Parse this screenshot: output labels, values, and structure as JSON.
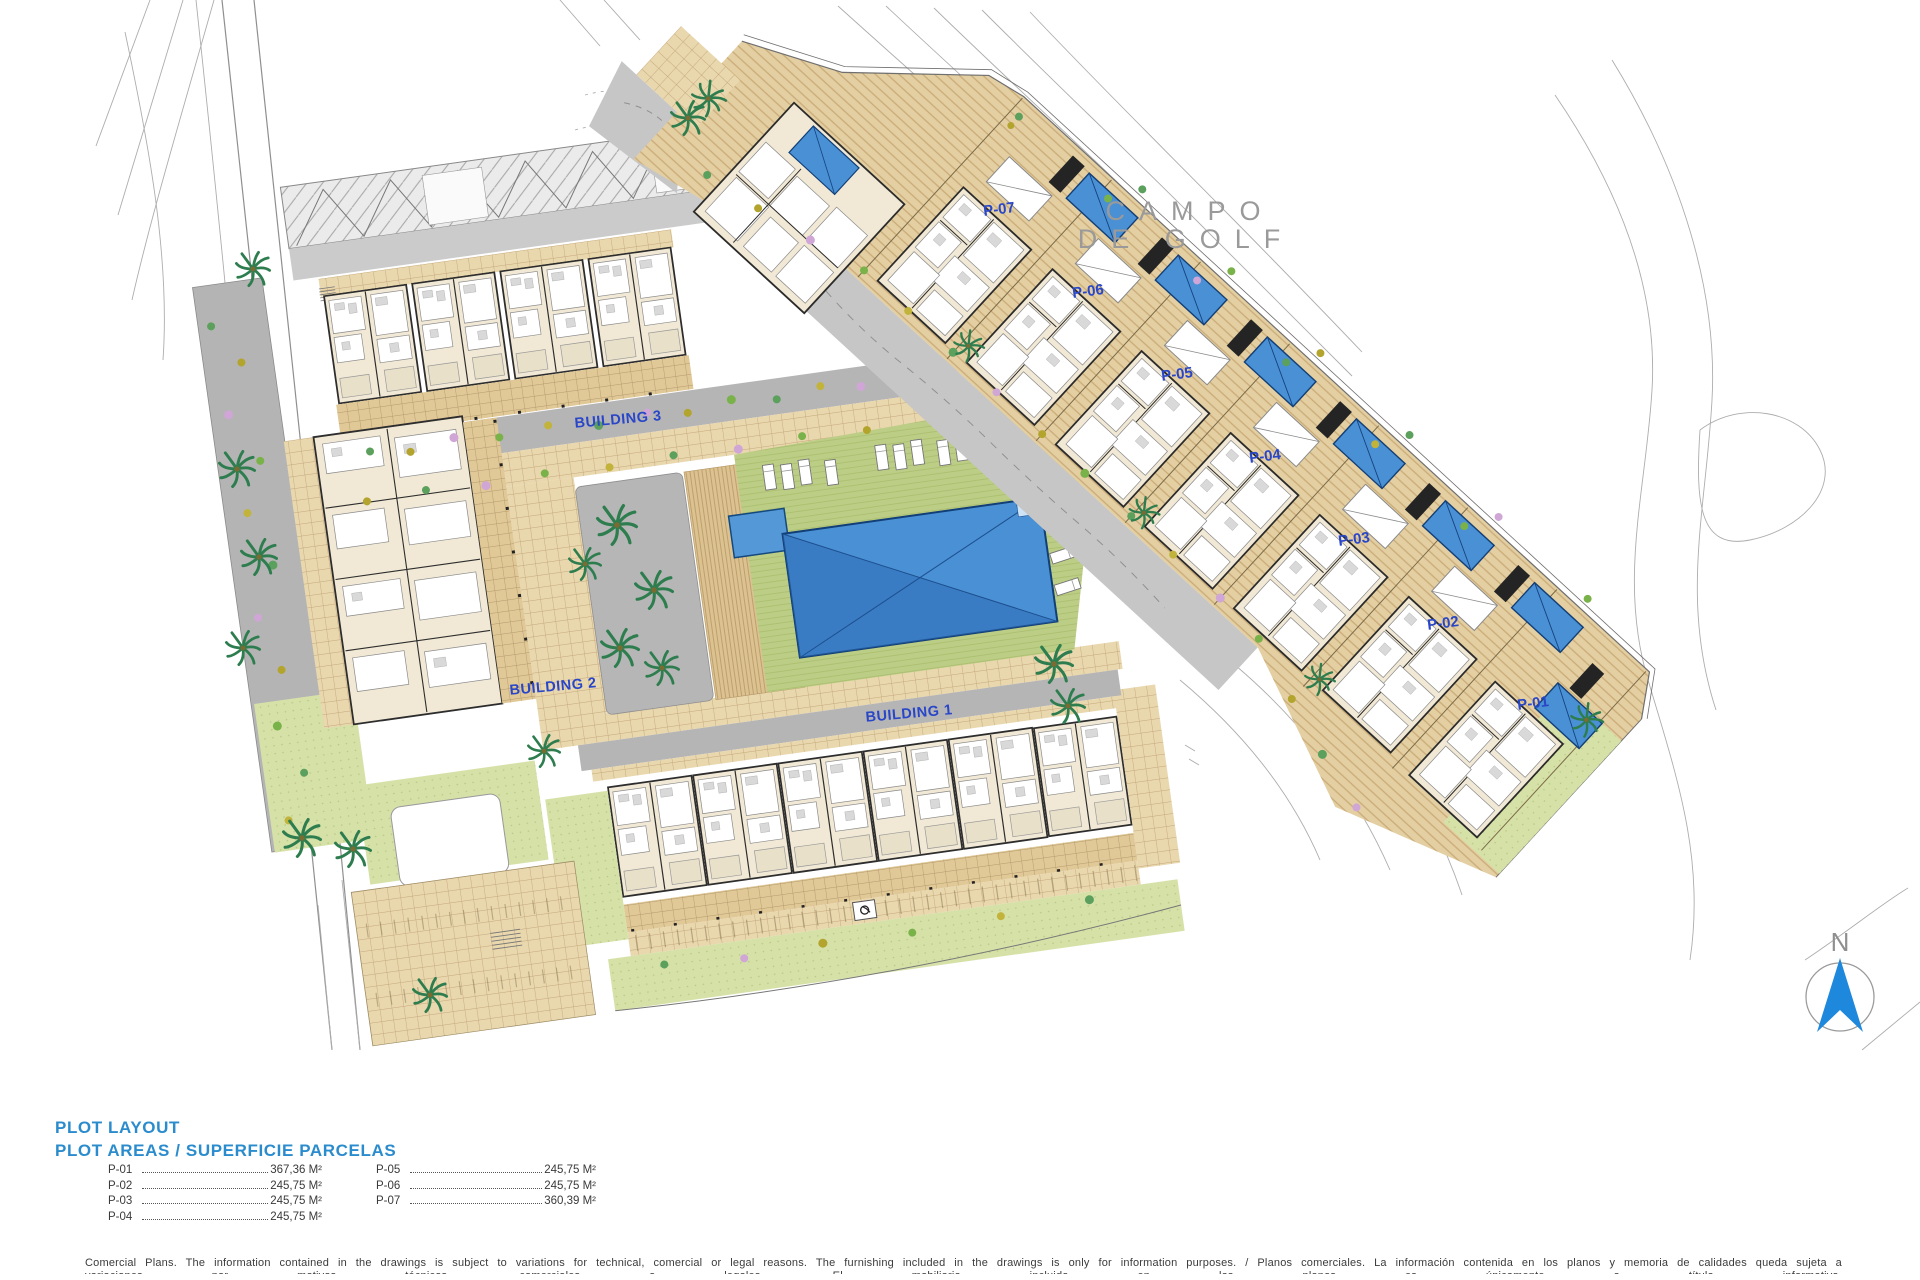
{
  "plan": {
    "golf_label": {
      "line1": "CAMPO",
      "line2": "DE GOLF"
    },
    "north": "N",
    "buildings": [
      {
        "label": "BUILDING 1"
      },
      {
        "label": "BUILDING 2"
      },
      {
        "label": "BUILDING 3"
      }
    ],
    "plots": [
      {
        "label": "P-01"
      },
      {
        "label": "P-02"
      },
      {
        "label": "P-03"
      },
      {
        "label": "P-04"
      },
      {
        "label": "P-05"
      },
      {
        "label": "P-06"
      },
      {
        "label": "P-07"
      }
    ]
  },
  "legend": {
    "title": "PLOT LAYOUT",
    "subtitle": "PLOT AREAS / SUPERFICIE PARCELAS",
    "columns": [
      {
        "entries": [
          {
            "plot": "P-01",
            "area": "367,36 M²"
          },
          {
            "plot": "P-02",
            "area": "245,75 M²"
          },
          {
            "plot": "P-03",
            "area": "245,75 M²"
          },
          {
            "plot": "P-04",
            "area": "245,75 M²"
          }
        ]
      },
      {
        "entries": [
          {
            "plot": "P-05",
            "area": "245,75 M²"
          },
          {
            "plot": "P-06",
            "area": "245,75 M²"
          },
          {
            "plot": "P-07",
            "area": "360,39 M²"
          }
        ]
      }
    ]
  },
  "footer": {
    "line1": "Comercial Plans. The information contained in the drawings is subject to variations for technical, comercial or legal reasons. The furnishing included in the drawings is only for information purposes. / Planos comerciales. La información contenida en los planos y memoria de calidades queda sujeta a",
    "line2": "variaciones por motivos técnicos, comerciales o legales. El mobiliario incluido en los planos es únicamente a título informativo."
  },
  "colors": {
    "label_blue": "#2946c8",
    "legend_blue": "#2b8ccd",
    "pool_blue": "#4a90d4",
    "compass_blue": "#1e88dd"
  }
}
